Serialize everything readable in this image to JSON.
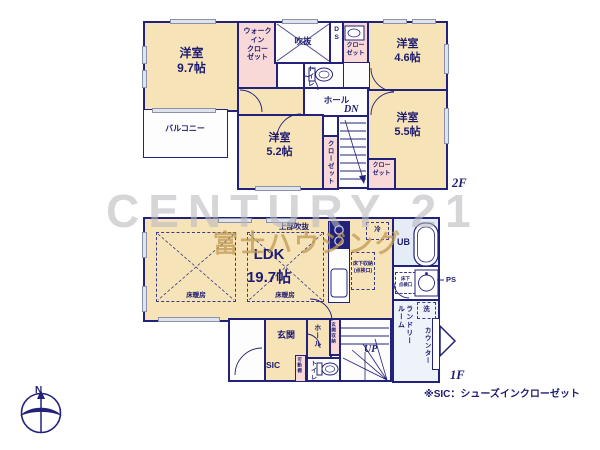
{
  "watermark": {
    "brand": "CENTURY 21",
    "company": "富士ハウジング"
  },
  "f2": {
    "floor_label": "2F",
    "room97": "洋室\n9.7帖",
    "balcony": "バルコニー",
    "wic": "ウォーク\nイン\nクロー\nゼット",
    "void": "吹抜",
    "ds": "DS",
    "closet_a": "クロー\nゼット",
    "room46": "洋室\n4.6帖",
    "toilet": "トイレ",
    "hall": "ホール",
    "dn": "DN",
    "room55": "洋室\n5.5帖",
    "closet55": "クロー\nゼット",
    "room52": "洋室\n5.2帖",
    "closet52": "クローゼット"
  },
  "f1": {
    "floor_label": "1F",
    "ldk": "LDK\n19.7帖",
    "upper_void": "上部吹抜",
    "floor_heating_1": "床暖房",
    "floor_heating_2": "床暖房",
    "fridge": "冷",
    "underfloor_storage": "床下収納\n(点検口)",
    "ub": "UB",
    "underfloor_access": "床下\n点検口",
    "ps": "PS",
    "laundry": "ランドリー\nルーム",
    "washer": "洗",
    "counter": "カウンター",
    "genkan": "玄関",
    "sic": "SIC",
    "shelf": "可動棚",
    "hall": "ホール",
    "genkan_storage": "玄関収納",
    "toilet": "トイレ",
    "up": "UP"
  },
  "note": "※SIC：シューズインクローゼット",
  "compass": {
    "north": "N"
  },
  "colors": {
    "wall": "#23227b",
    "room_cream": "#f7e3b8",
    "closet_pink": "#f8d9d8",
    "bath_blue": "#e4ecf5",
    "ink_navy": "#1d1c70",
    "brand_gray": "#b9b9bd",
    "company_gold": "#c09a52"
  }
}
